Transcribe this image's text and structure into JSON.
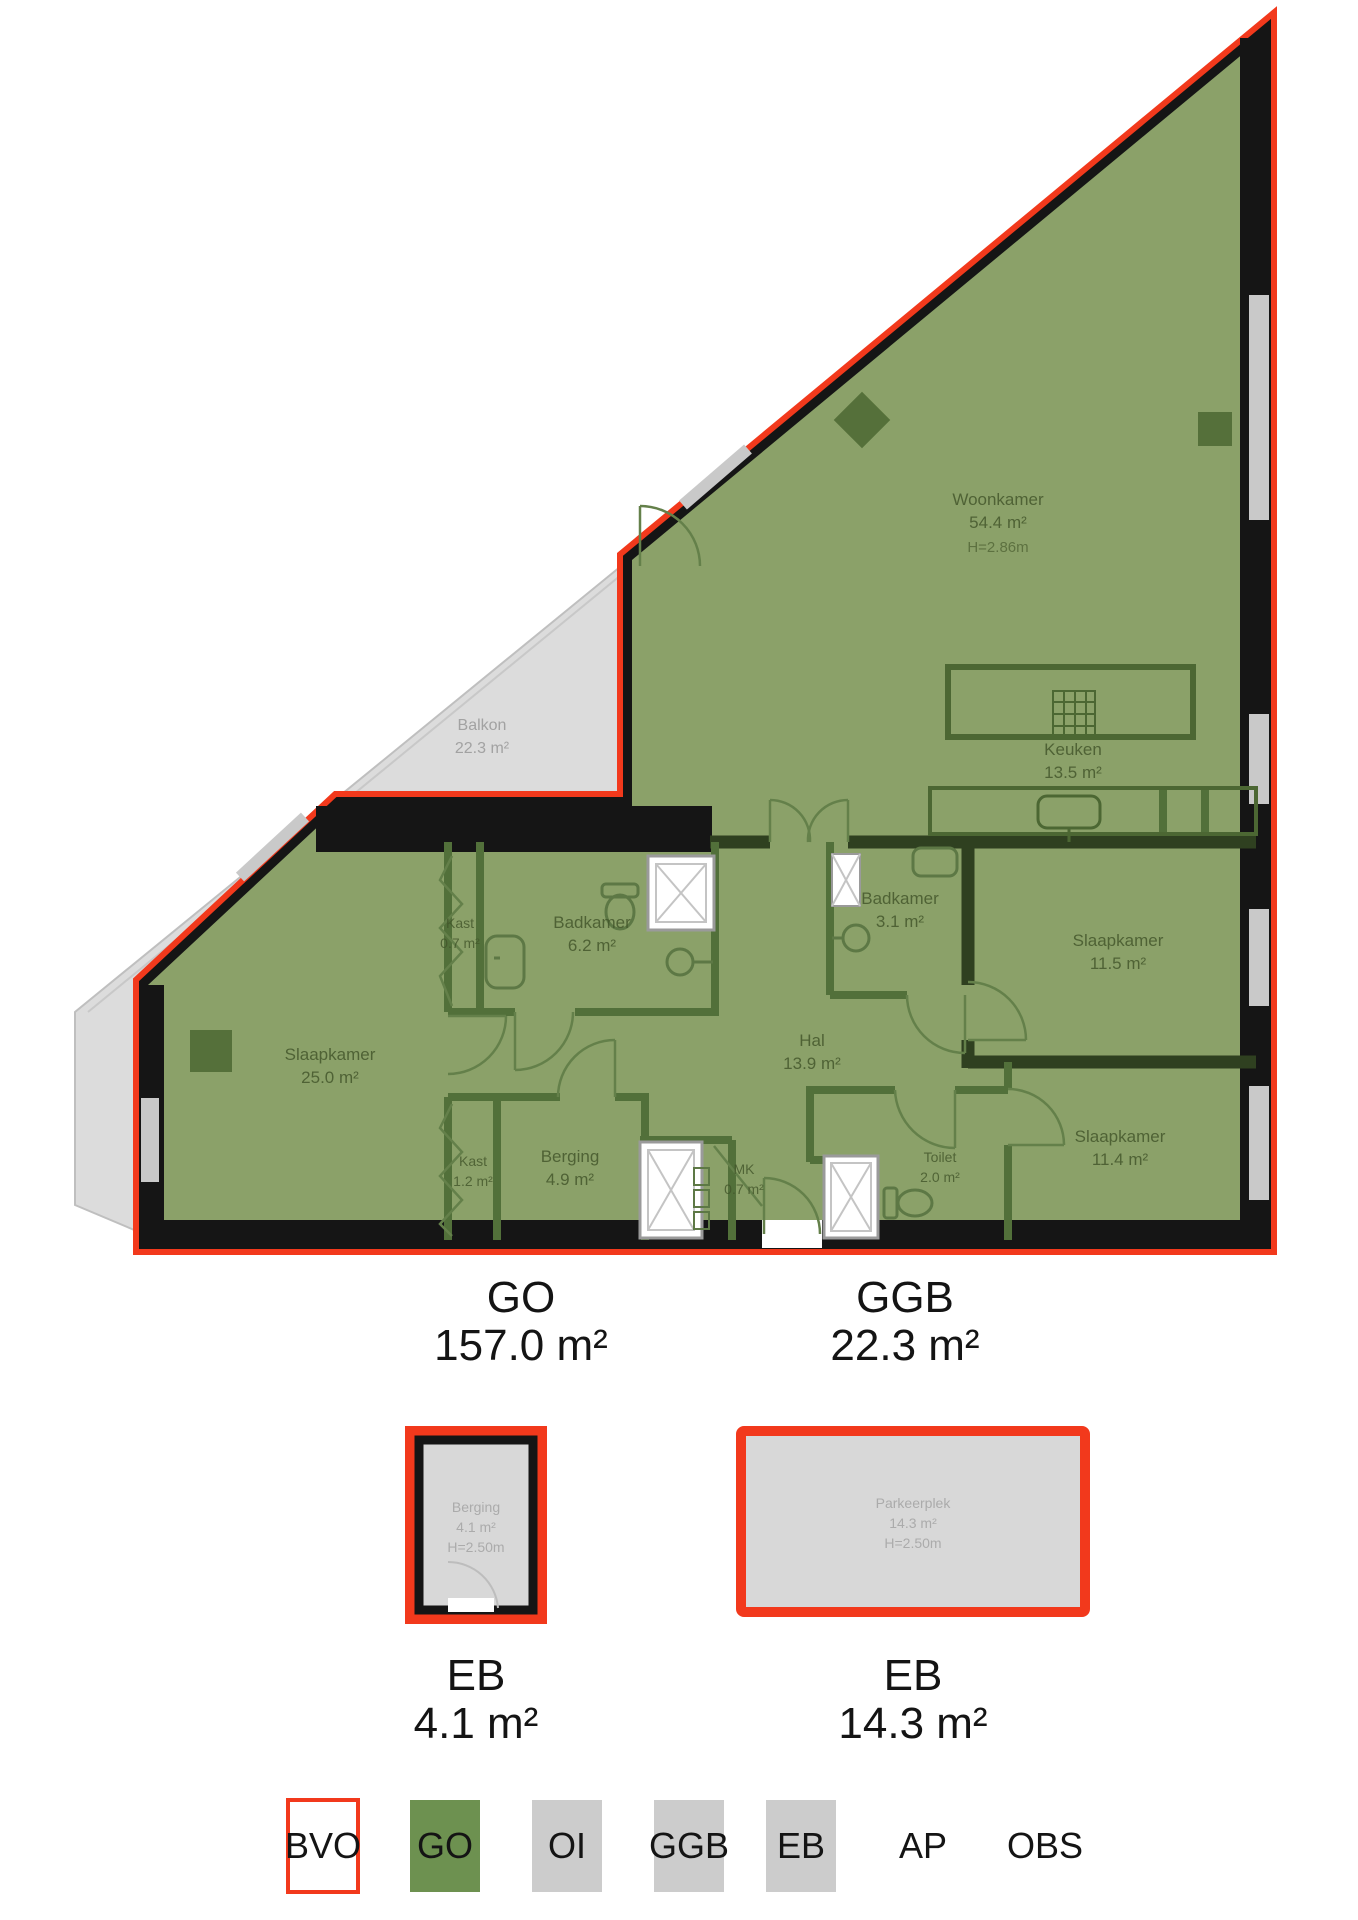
{
  "plan": {
    "title_rooms": "floorplan rooms",
    "rooms": [
      {
        "name": "Woonkamer",
        "area": "54.4 m²",
        "height": "H=2.86m"
      },
      {
        "name": "Keuken",
        "area": "13.5 m²"
      },
      {
        "name": "Balkon",
        "area": "22.3 m²"
      },
      {
        "name": "Kast",
        "area": "0.7 m²"
      },
      {
        "name": "Badkamer",
        "area": "6.2 m²"
      },
      {
        "name": "Badkamer",
        "area": "3.1 m²"
      },
      {
        "name": "Slaapkamer",
        "area": "11.5 m²"
      },
      {
        "name": "Hal",
        "area": "13.9 m²"
      },
      {
        "name": "Slaapkamer",
        "area": "25.0 m²"
      },
      {
        "name": "Kast",
        "area": "1.2 m²"
      },
      {
        "name": "Berging",
        "area": "4.9 m²"
      },
      {
        "name": "MK",
        "area": "0.7 m²"
      },
      {
        "name": "Toilet",
        "area": "2.0 m²"
      },
      {
        "name": "Slaapkamer",
        "area": "11.4 m²"
      }
    ],
    "summary": [
      {
        "code": "GO",
        "area": "157.0 m²"
      },
      {
        "code": "GGB",
        "area": "22.3 m²"
      }
    ],
    "annexes": [
      {
        "name": "Berging",
        "area": "4.1 m²",
        "ceiling": "H=2.50m",
        "code": "EB"
      },
      {
        "name": "Parkeerplek",
        "area": "14.3 m²",
        "ceiling": "H=2.50m",
        "code": "EB"
      }
    ],
    "legend": [
      {
        "code": "BVO",
        "swatch": "outline-red"
      },
      {
        "code": "GO",
        "swatch": "green"
      },
      {
        "code": "OI",
        "swatch": "gray"
      },
      {
        "code": "GGB",
        "swatch": "gray"
      },
      {
        "code": "EB",
        "swatch": "gray"
      },
      {
        "code": "AP",
        "swatch": "none"
      },
      {
        "code": "OBS",
        "swatch": "none"
      }
    ],
    "colors": {
      "go_fill": "#8ba169",
      "legend_green": "#6d9150",
      "outline_red": "#f2391c",
      "wall_black": "#151515",
      "balcony_gray": "#dcdcdc",
      "legend_gray": "#cccccc",
      "interior_wall_green": "#3f5526",
      "partition_green": "#52703a",
      "label_green": "#42552a",
      "label_gray": "#a2a2a2"
    }
  }
}
